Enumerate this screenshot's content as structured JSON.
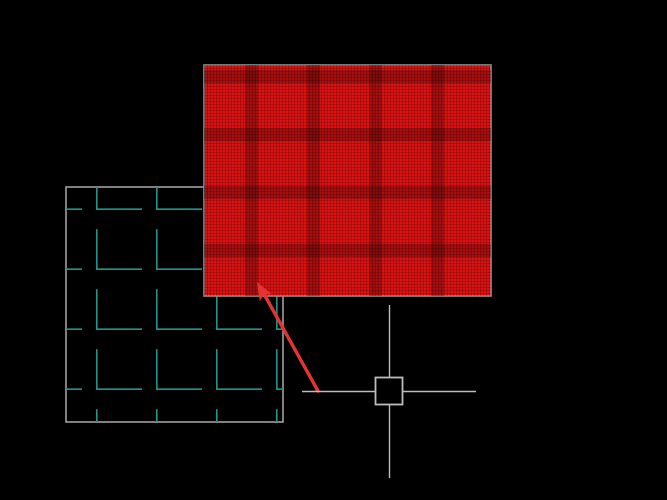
{
  "app": {
    "kind": "cad-drawing-canvas",
    "background": "#000000"
  },
  "colors": {
    "canvas_bg": "#000000",
    "hatch_fill": "#dd1212",
    "hatch_fine_line": "rgba(60,0,0,0.30)",
    "hatch_band": "rgba(0,0,0,0.24)",
    "hatch_outline": "#9c9090",
    "grid_outline": "#a0a0a0",
    "grid_fill": "#000000",
    "grid_line_cyan": "#23948d",
    "crosshair_gray": "#bcbcbc",
    "pickbox_fill": "#000000",
    "arrow_red": "#e23434"
  },
  "objects": {
    "hatched_rectangle": {
      "label": "red-hatched rectangle entity",
      "pattern": "dense red crosshatch with darker bands"
    },
    "grid_rectangle": {
      "label": "tile-pattern rectangle entity",
      "pattern": "cyan L-shaped tile hatch"
    },
    "annotation_arrow": {
      "label": "red callout arrow pointing at hatched rectangle"
    },
    "cursor": {
      "label": "crosshair cursor with pickbox"
    }
  }
}
